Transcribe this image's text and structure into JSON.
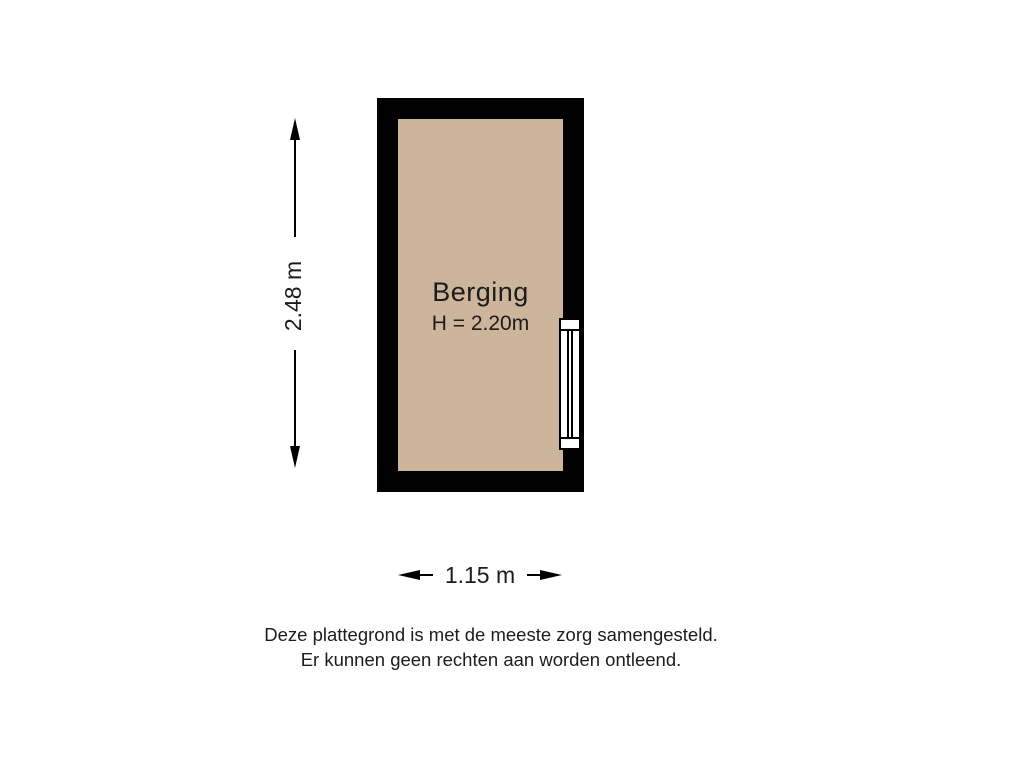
{
  "floorplan": {
    "room": {
      "label": "Berging",
      "ceiling_height_label": "H = 2.20m"
    },
    "dimensions": {
      "height": "2.48 m",
      "width": "1.15 m"
    },
    "features": {
      "window": "window-on-right-wall"
    },
    "disclaimer_line1": "Deze plattegrond is met de meeste zorg samengesteld.",
    "disclaimer_line2": "Er kunnen geen rechten aan worden ontleend.",
    "colors": {
      "wall": "#000000",
      "floor": "#ccb59b",
      "background": "#ffffff",
      "text": "#1c1c1c"
    }
  }
}
